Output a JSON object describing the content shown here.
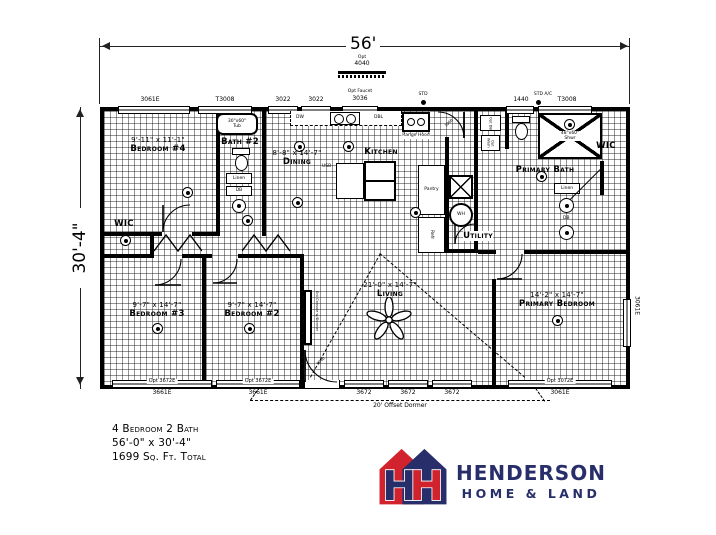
{
  "dimensions": {
    "top": "56'",
    "left": "30'-4\""
  },
  "opt_window": {
    "line1": "Opt",
    "line2": "4040"
  },
  "wall_labels": {
    "top": [
      "3061E",
      "T3008",
      "3022",
      "3022",
      "Opt Faucet",
      "3036",
      "STD",
      "1440",
      "STD A/C",
      "T3008"
    ],
    "bottom_inside": [
      "Opt 3672E",
      "Opt 3672E",
      "Opt 3072E"
    ],
    "bottom_outside": [
      "3661E",
      "3661E",
      "3672",
      "3672",
      "3672",
      "3061E"
    ],
    "right": "3061E",
    "dormer": "20' Offset Dormer"
  },
  "rooms": {
    "bedroom4": {
      "dims": "9'-11\" x 11'-1\"",
      "name": "Bedroom #4"
    },
    "bath2": {
      "name": "Bath #2"
    },
    "dining": {
      "dims": "8'-8\" x 14'-7\"",
      "name": "Dining"
    },
    "kitchen": {
      "name": "Kitchen"
    },
    "utility": {
      "name": "Utility"
    },
    "primary_bath": {
      "name": "Primary Bath"
    },
    "wic_right": {
      "name": "WIC"
    },
    "wic_left": {
      "name": "WIC"
    },
    "bedroom3": {
      "dims": "9'-7\" x 14'-7\"",
      "name": "Bedroom #3"
    },
    "bedroom2": {
      "dims": "9'-7\" x 14'-7\"",
      "name": "Bedroom #2"
    },
    "living": {
      "dims": "21'-0\" x 14'-7\"",
      "name": "Living"
    },
    "primary_bedroom": {
      "dims": "14'-2\" x 14'-7\"",
      "name": "Primary Bedroom"
    }
  },
  "fixtures": {
    "tub_size": "30\"x60\"",
    "tub": "Tub",
    "shower_size": "48\"x60\"",
    "shower": "Shwr",
    "linen": "Linen",
    "db": "DB",
    "opt_db": "Opt DB",
    "opt_wash": "Opt Wash",
    "furn": "Furn",
    "wh": "WH",
    "pantry": "Pantry",
    "refr": "Refr",
    "dw": "DW",
    "dbl": "DBL",
    "range_hood": "Range Hood",
    "usb": "USB",
    "ent_console": "Ent Console w/Dormer"
  },
  "doors": {
    "exterior_top": "3068",
    "front": "3068"
  },
  "summary": {
    "beds_baths": "4 Bedroom 2 Bath",
    "size": "56'-0\" x 30'-4\"",
    "sqft": "1699 Sq. Ft. Total"
  },
  "logo": {
    "brand": "HENDERSON",
    "tagline": "HOME & LAND",
    "monogram": "H",
    "colors": {
      "navy": "#272e6a",
      "red": "#d1232e"
    }
  }
}
